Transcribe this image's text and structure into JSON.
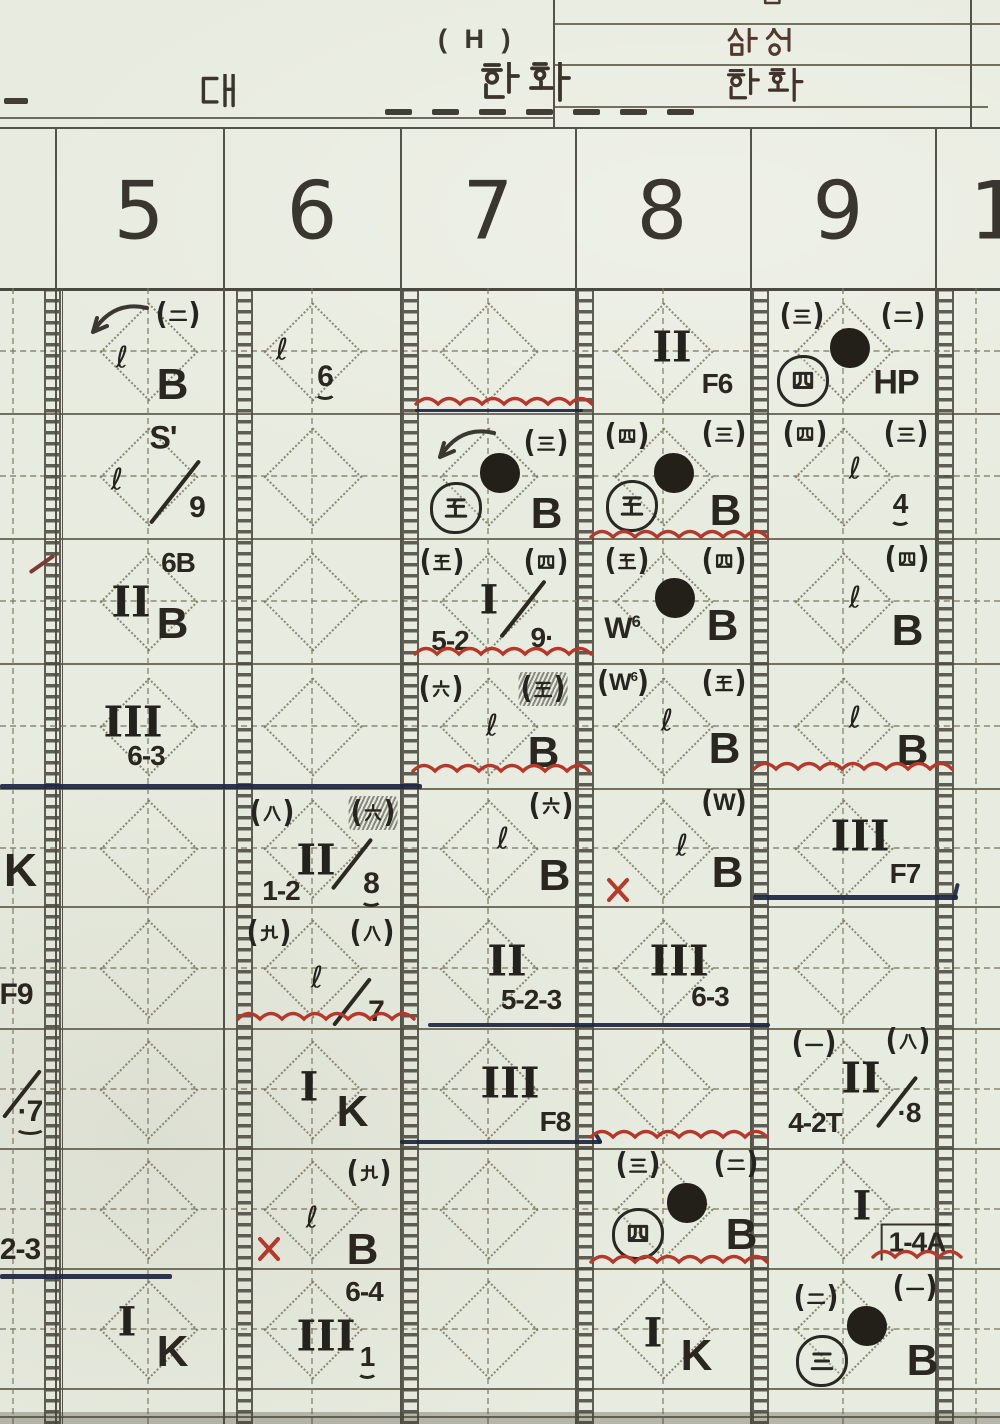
{
  "header": {
    "game_note": "( H )",
    "team_left": "한화",
    "vs_label": "대",
    "score_box": {
      "top_partial": "름",
      "row1": "삼성",
      "row2": "한화"
    }
  },
  "inning_header": {
    "columns": [
      "5",
      "6",
      "7",
      "8",
      "9"
    ],
    "partial_right": "1"
  },
  "ink_colors": {
    "paper": "#e8ebdf",
    "red": "#b5382b",
    "navy": "#1d2742",
    "ink": "#26241e"
  },
  "marks": [
    {
      "cell": "i4r2",
      "t": "slash",
      "x": 42,
      "y": 562,
      "len": 30,
      "rot": -35,
      "c": "maroon"
    },
    {
      "cell": "i4r5",
      "t": "txt",
      "v": "K",
      "x": 20,
      "y": 870,
      "fs": 46
    },
    {
      "cell": "i4r6",
      "t": "txt",
      "v": "F9",
      "x": 16,
      "y": 995,
      "fs": 30
    },
    {
      "cell": "i4r7",
      "t": "slash",
      "x": 22,
      "y": 1092,
      "len": 60,
      "rot": -52
    },
    {
      "cell": "i4r7",
      "t": "txt",
      "v": "·7",
      "x": 30,
      "y": 1112,
      "fs": 30,
      "u": true
    },
    {
      "cell": "i4r8",
      "t": "txt",
      "v": "2-3",
      "x": 20,
      "y": 1250,
      "fs": 30
    },
    {
      "cell": "i5r1",
      "t": "arrow",
      "x": 118,
      "y": 322
    },
    {
      "cell": "i5r1",
      "t": "pk",
      "v": "二",
      "x": 178,
      "y": 315
    },
    {
      "cell": "i5r1",
      "t": "ell",
      "v": "ℓ",
      "x": 122,
      "y": 358
    },
    {
      "cell": "i5r1",
      "t": "txt",
      "v": "B",
      "x": 172,
      "y": 385,
      "fs": 44
    },
    {
      "cell": "i5r2",
      "t": "txt",
      "v": "S'",
      "x": 163,
      "y": 438,
      "fs": 32
    },
    {
      "cell": "i5r2",
      "t": "ell",
      "v": "ℓ",
      "x": 117,
      "y": 480
    },
    {
      "cell": "i5r2",
      "t": "slash",
      "x": 175,
      "y": 490,
      "len": 80,
      "rot": -52
    },
    {
      "cell": "i5r2",
      "t": "txt",
      "v": "9",
      "x": 197,
      "y": 508,
      "fs": 30
    },
    {
      "cell": "i5r3",
      "t": "txt",
      "v": "6B",
      "x": 178,
      "y": 563,
      "fs": 28
    },
    {
      "cell": "i5r3",
      "t": "rom",
      "v": "II",
      "x": 131,
      "y": 602,
      "fs": 42
    },
    {
      "cell": "i5r3",
      "t": "txt",
      "v": "B",
      "x": 172,
      "y": 624,
      "fs": 44
    },
    {
      "cell": "i5r4",
      "t": "rom",
      "v": "III",
      "x": 133,
      "y": 722,
      "fs": 42
    },
    {
      "cell": "i5r4",
      "t": "txt",
      "v": "6-3",
      "x": 146,
      "y": 756,
      "fs": 28
    },
    {
      "cell": "i5r9",
      "t": "rom",
      "v": "I",
      "x": 127,
      "y": 1322,
      "fs": 40
    },
    {
      "cell": "i5r9",
      "t": "txt",
      "v": "K",
      "x": 172,
      "y": 1352,
      "fs": 44
    },
    {
      "cell": "i6r1",
      "t": "ell",
      "v": "ℓ",
      "x": 282,
      "y": 350
    },
    {
      "cell": "i6r1",
      "t": "txt",
      "v": "6",
      "x": 325,
      "y": 377,
      "fs": 30,
      "u": true
    },
    {
      "cell": "i6r5",
      "t": "pk",
      "v": "八",
      "x": 272,
      "y": 813
    },
    {
      "cell": "i6r5",
      "t": "pk",
      "v": "六",
      "x": 373,
      "y": 813,
      "scr": true
    },
    {
      "cell": "i6r5",
      "t": "rom",
      "v": "II",
      "x": 316,
      "y": 860,
      "fs": 42
    },
    {
      "cell": "i6r5",
      "t": "slash",
      "x": 352,
      "y": 862,
      "len": 64,
      "rot": -52
    },
    {
      "cell": "i6r5",
      "t": "txt",
      "v": "8",
      "x": 371,
      "y": 884,
      "fs": 30,
      "u": true
    },
    {
      "cell": "i6r5",
      "t": "txt",
      "v": "1-2",
      "x": 281,
      "y": 891,
      "fs": 28
    },
    {
      "cell": "i6r6",
      "t": "pk",
      "v": "九",
      "x": 269,
      "y": 933
    },
    {
      "cell": "i6r6",
      "t": "pk",
      "v": "八",
      "x": 372,
      "y": 933
    },
    {
      "cell": "i6r6",
      "t": "ell",
      "v": "ℓ",
      "x": 317,
      "y": 978
    },
    {
      "cell": "i6r6",
      "t": "slash",
      "x": 352,
      "y": 1000,
      "len": 60,
      "rot": -52
    },
    {
      "cell": "i6r6",
      "t": "txt",
      "v": "7",
      "x": 376,
      "y": 1012,
      "fs": 30
    },
    {
      "cell": "i6r7",
      "t": "rom",
      "v": "I",
      "x": 309,
      "y": 1087,
      "fs": 40
    },
    {
      "cell": "i6r7",
      "t": "txt",
      "v": "K",
      "x": 352,
      "y": 1112,
      "fs": 44
    },
    {
      "cell": "i6r8",
      "t": "pk",
      "v": "九",
      "x": 369,
      "y": 1173
    },
    {
      "cell": "i6r8",
      "t": "ell",
      "v": "ℓ",
      "x": 312,
      "y": 1218
    },
    {
      "cell": "i6r8",
      "t": "txt",
      "v": "B",
      "x": 362,
      "y": 1250,
      "fs": 44
    },
    {
      "cell": "i6r8",
      "t": "x",
      "x": 269,
      "y": 1249
    },
    {
      "cell": "i6r9",
      "t": "txt",
      "v": "6-4",
      "x": 364,
      "y": 1292,
      "fs": 28
    },
    {
      "cell": "i6r9",
      "t": "rom",
      "v": "III",
      "x": 326,
      "y": 1336,
      "fs": 42
    },
    {
      "cell": "i6r9",
      "t": "txt",
      "v": "1",
      "x": 367,
      "y": 1357,
      "fs": 28,
      "u": true
    },
    {
      "cell": "i7r2",
      "t": "arrow",
      "x": 465,
      "y": 447
    },
    {
      "cell": "i7r2",
      "t": "pk",
      "v": "三",
      "x": 546,
      "y": 443
    },
    {
      "cell": "i7r2",
      "t": "dot",
      "x": 500,
      "y": 473
    },
    {
      "cell": "i7r2",
      "t": "ck",
      "v": "五",
      "x": 456,
      "y": 508
    },
    {
      "cell": "i7r2",
      "t": "txt",
      "v": "B",
      "x": 546,
      "y": 514,
      "fs": 44
    },
    {
      "cell": "i7r3",
      "t": "pk",
      "v": "五",
      "x": 442,
      "y": 562
    },
    {
      "cell": "i7r3",
      "t": "pk",
      "v": "四",
      "x": 546,
      "y": 562
    },
    {
      "cell": "i7r3",
      "t": "rom",
      "v": "I",
      "x": 489,
      "y": 600,
      "fs": 40
    },
    {
      "cell": "i7r3",
      "t": "slash",
      "x": 523,
      "y": 607,
      "len": 72,
      "rot": -52
    },
    {
      "cell": "i7r3",
      "t": "txt",
      "v": "9·",
      "x": 542,
      "y": 638,
      "fs": 28
    },
    {
      "cell": "i7r3",
      "t": "txt",
      "v": "5-2",
      "x": 450,
      "y": 641,
      "fs": 28
    },
    {
      "cell": "i7r4",
      "t": "pk",
      "v": "六",
      "x": 441,
      "y": 689
    },
    {
      "cell": "i7r4",
      "t": "pk",
      "v": "五",
      "x": 543,
      "y": 689,
      "scr": true
    },
    {
      "cell": "i7r4",
      "t": "ell",
      "v": "ℓ",
      "x": 492,
      "y": 726
    },
    {
      "cell": "i7r4",
      "t": "txt",
      "v": "B",
      "x": 543,
      "y": 753,
      "fs": 44
    },
    {
      "cell": "i7r5",
      "t": "pk",
      "v": "六",
      "x": 551,
      "y": 806
    },
    {
      "cell": "i7r5",
      "t": "ell",
      "v": "ℓ",
      "x": 503,
      "y": 839
    },
    {
      "cell": "i7r5",
      "t": "txt",
      "v": "B",
      "x": 554,
      "y": 876,
      "fs": 44
    },
    {
      "cell": "i7r6",
      "t": "rom",
      "v": "II",
      "x": 507,
      "y": 961,
      "fs": 42
    },
    {
      "cell": "i7r6",
      "t": "txt",
      "v": "5-2-3",
      "x": 531,
      "y": 1000,
      "fs": 28
    },
    {
      "cell": "i7r7",
      "t": "rom",
      "v": "III",
      "x": 510,
      "y": 1083,
      "fs": 42
    },
    {
      "cell": "i7r7",
      "t": "txt",
      "v": "F8",
      "x": 555,
      "y": 1122,
      "fs": 28
    },
    {
      "cell": "i8r1",
      "t": "rom",
      "v": "II",
      "x": 672,
      "y": 347,
      "fs": 42
    },
    {
      "cell": "i8r1",
      "t": "txt",
      "v": "F6",
      "x": 717,
      "y": 384,
      "fs": 28
    },
    {
      "cell": "i8r2",
      "t": "pk",
      "v": "四",
      "x": 627,
      "y": 436
    },
    {
      "cell": "i8r2",
      "t": "pk",
      "v": "三",
      "x": 724,
      "y": 434
    },
    {
      "cell": "i8r2",
      "t": "dot",
      "x": 674,
      "y": 473
    },
    {
      "cell": "i8r2",
      "t": "ck",
      "v": "五",
      "x": 632,
      "y": 506
    },
    {
      "cell": "i8r2",
      "t": "txt",
      "v": "B",
      "x": 725,
      "y": 511,
      "fs": 44
    },
    {
      "cell": "i8r3",
      "t": "pk",
      "v": "五",
      "x": 627,
      "y": 561
    },
    {
      "cell": "i8r3",
      "t": "pk",
      "v": "四",
      "x": 724,
      "y": 561
    },
    {
      "cell": "i8r3",
      "t": "dot",
      "x": 675,
      "y": 598
    },
    {
      "cell": "i8r3",
      "t": "txt",
      "v": "W",
      "sup": "6",
      "x": 622,
      "y": 629,
      "fs": 30
    },
    {
      "cell": "i8r3",
      "t": "txt",
      "v": "B",
      "x": 722,
      "y": 626,
      "fs": 44
    },
    {
      "cell": "i8r4",
      "t": "pk",
      "v": "W",
      "sup": "6",
      "x": 623,
      "y": 683
    },
    {
      "cell": "i8r4",
      "t": "pk",
      "v": "五",
      "x": 724,
      "y": 683
    },
    {
      "cell": "i8r4",
      "t": "ell",
      "v": "ℓ",
      "x": 667,
      "y": 721
    },
    {
      "cell": "i8r4",
      "t": "txt",
      "v": "B",
      "x": 724,
      "y": 749,
      "fs": 44
    },
    {
      "cell": "i8r5",
      "t": "pk",
      "v": "W",
      "x": 724,
      "y": 803
    },
    {
      "cell": "i8r5",
      "t": "ell",
      "v": "ℓ",
      "x": 682,
      "y": 846
    },
    {
      "cell": "i8r5",
      "t": "txt",
      "v": "B",
      "x": 727,
      "y": 873,
      "fs": 44
    },
    {
      "cell": "i8r5",
      "t": "x",
      "x": 618,
      "y": 890
    },
    {
      "cell": "i8r6",
      "t": "rom",
      "v": "III",
      "x": 679,
      "y": 961,
      "fs": 42
    },
    {
      "cell": "i8r6",
      "t": "txt",
      "v": "6-3",
      "x": 710,
      "y": 997,
      "fs": 28
    },
    {
      "cell": "i8r8",
      "t": "pk",
      "v": "三",
      "x": 638,
      "y": 1165
    },
    {
      "cell": "i8r8",
      "t": "pk",
      "v": "二",
      "x": 736,
      "y": 1164
    },
    {
      "cell": "i8r8",
      "t": "dot",
      "x": 687,
      "y": 1203
    },
    {
      "cell": "i8r8",
      "t": "ck",
      "v": "四",
      "x": 638,
      "y": 1234
    },
    {
      "cell": "i8r8",
      "t": "txt",
      "v": "B",
      "x": 741,
      "y": 1235,
      "fs": 44
    },
    {
      "cell": "i8r9",
      "t": "rom",
      "v": "I",
      "x": 653,
      "y": 1333,
      "fs": 40
    },
    {
      "cell": "i8r9",
      "t": "txt",
      "v": "K",
      "x": 696,
      "y": 1356,
      "fs": 44
    },
    {
      "cell": "i9r1",
      "t": "pk",
      "v": "三",
      "x": 802,
      "y": 316
    },
    {
      "cell": "i9r1",
      "t": "pk",
      "v": "二",
      "x": 903,
      "y": 316
    },
    {
      "cell": "i9r1",
      "t": "dot",
      "x": 850,
      "y": 348
    },
    {
      "cell": "i9r1",
      "t": "ck",
      "v": "四",
      "x": 803,
      "y": 381
    },
    {
      "cell": "i9r1",
      "t": "txt",
      "v": "HP",
      "x": 896,
      "y": 383,
      "fs": 34
    },
    {
      "cell": "i9r2",
      "t": "pk",
      "v": "四",
      "x": 805,
      "y": 434
    },
    {
      "cell": "i9r2",
      "t": "pk",
      "v": "三",
      "x": 906,
      "y": 434
    },
    {
      "cell": "i9r2",
      "t": "ell",
      "v": "ℓ",
      "x": 855,
      "y": 469
    },
    {
      "cell": "i9r2",
      "t": "txt",
      "v": "4",
      "x": 900,
      "y": 504,
      "fs": 28,
      "u": true
    },
    {
      "cell": "i9r3",
      "t": "pk",
      "v": "四",
      "x": 907,
      "y": 559
    },
    {
      "cell": "i9r3",
      "t": "ell",
      "v": "ℓ",
      "x": 855,
      "y": 598
    },
    {
      "cell": "i9r3",
      "t": "txt",
      "v": "B",
      "x": 907,
      "y": 631,
      "fs": 44
    },
    {
      "cell": "i9r4",
      "t": "ell",
      "v": "ℓ",
      "x": 855,
      "y": 718
    },
    {
      "cell": "i9r4",
      "t": "txt",
      "v": "B",
      "x": 912,
      "y": 751,
      "fs": 44
    },
    {
      "cell": "i9r5",
      "t": "rom",
      "v": "III",
      "x": 860,
      "y": 836,
      "fs": 42
    },
    {
      "cell": "i9r5",
      "t": "txt",
      "v": "F7",
      "x": 905,
      "y": 874,
      "fs": 28
    },
    {
      "cell": "i9r7",
      "t": "pk",
      "v": "一",
      "x": 814,
      "y": 1044
    },
    {
      "cell": "i9r7",
      "t": "pk",
      "v": "八",
      "x": 908,
      "y": 1041
    },
    {
      "cell": "i9r7",
      "t": "rom",
      "v": "II",
      "x": 861,
      "y": 1078,
      "fs": 42
    },
    {
      "cell": "i9r7",
      "t": "slash",
      "x": 897,
      "y": 1100,
      "len": 64,
      "rot": -52
    },
    {
      "cell": "i9r7",
      "t": "txt",
      "v": "·8",
      "x": 909,
      "y": 1113,
      "fs": 28
    },
    {
      "cell": "i9r7",
      "t": "txt",
      "v": "4-2T",
      "x": 815,
      "y": 1123,
      "fs": 28
    },
    {
      "cell": "i9r8",
      "t": "rom",
      "v": "I",
      "x": 862,
      "y": 1206,
      "fs": 40
    },
    {
      "cell": "i9r8",
      "t": "txt",
      "v": "1-4A",
      "x": 915,
      "y": 1242,
      "fs": 28,
      "box": "half"
    },
    {
      "cell": "i9r9",
      "t": "pk",
      "v": "二",
      "x": 816,
      "y": 1298
    },
    {
      "cell": "i9r9",
      "t": "pk",
      "v": "一",
      "x": 915,
      "y": 1288
    },
    {
      "cell": "i9r9",
      "t": "dot",
      "x": 867,
      "y": 1326
    },
    {
      "cell": "i9r9",
      "t": "ck",
      "v": "三",
      "x": 822,
      "y": 1361
    },
    {
      "cell": "i9r9",
      "t": "txt",
      "v": "B",
      "x": 922,
      "y": 1361,
      "fs": 44
    }
  ],
  "wavy_lines": [
    {
      "x": 415,
      "y": 401,
      "w": 172
    },
    {
      "x": 590,
      "y": 534,
      "w": 168
    },
    {
      "x": 414,
      "y": 651,
      "w": 170
    },
    {
      "x": 412,
      "y": 768,
      "w": 170
    },
    {
      "x": 753,
      "y": 766,
      "w": 192
    },
    {
      "x": 237,
      "y": 1016,
      "w": 182
    },
    {
      "x": 590,
      "y": 1134,
      "w": 178
    },
    {
      "x": 590,
      "y": 1259,
      "w": 178
    },
    {
      "x": 872,
      "y": 1254,
      "w": 92
    }
  ],
  "navy_lines": [
    {
      "x": 415,
      "y": 409,
      "w": 168,
      "h": 3
    },
    {
      "x": 0,
      "y": 784,
      "w": 422,
      "h": 4.5
    },
    {
      "x": 753,
      "y": 895,
      "w": 205,
      "h": 4.5,
      "end": "hook"
    },
    {
      "x": 428,
      "y": 1023,
      "w": 342,
      "h": 3.5
    },
    {
      "x": 400,
      "y": 1140,
      "w": 202,
      "h": 3.5,
      "end": "tick"
    },
    {
      "x": 0,
      "y": 1274,
      "w": 172,
      "h": 4.5
    }
  ]
}
